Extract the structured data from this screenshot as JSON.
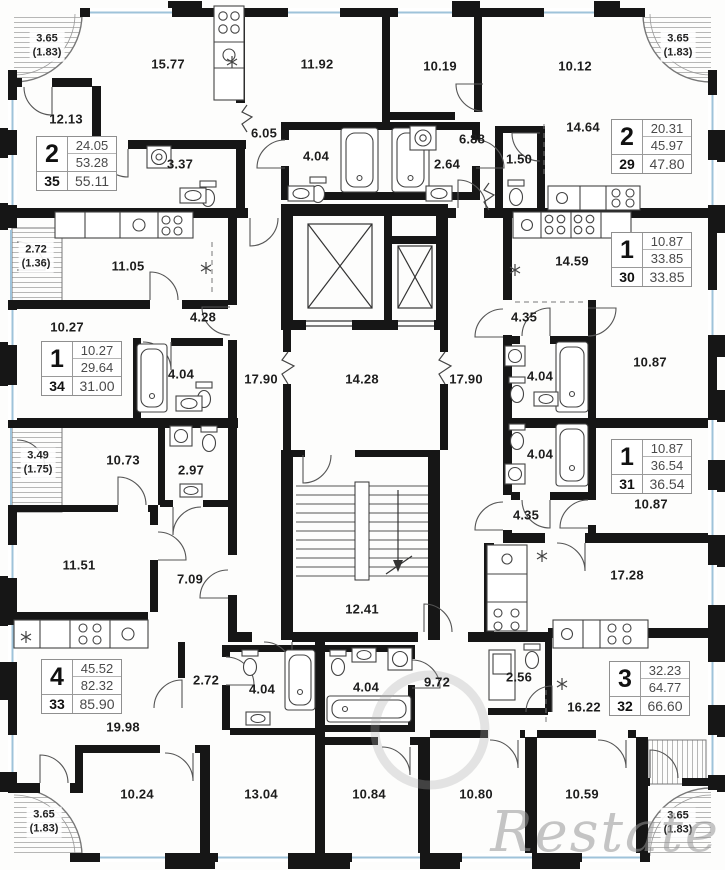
{
  "watermark": "Restate",
  "apartments": [
    {
      "rooms": "2",
      "living": "24.05",
      "area": "53.28",
      "number": "35",
      "total": "55.11"
    },
    {
      "rooms": "2",
      "living": "20.31",
      "area": "45.97",
      "number": "29",
      "total": "47.80"
    },
    {
      "rooms": "1",
      "living": "10.27",
      "area": "29.64",
      "number": "34",
      "total": "31.00"
    },
    {
      "rooms": "1",
      "living": "10.87",
      "area": "33.85",
      "number": "30",
      "total": "33.85"
    },
    {
      "rooms": "1",
      "living": "10.87",
      "area": "36.54",
      "number": "31",
      "total": "36.54"
    },
    {
      "rooms": "4",
      "living": "45.52",
      "area": "82.32",
      "number": "33",
      "total": "85.90"
    },
    {
      "rooms": "3",
      "living": "32.23",
      "area": "64.77",
      "number": "32",
      "total": "66.60"
    }
  ],
  "room_labels": [
    {
      "v": "15.77"
    },
    {
      "v": "12.13"
    },
    {
      "v": "3.37"
    },
    {
      "v": "6.05"
    },
    {
      "v": "11.92"
    },
    {
      "v": "4.04"
    },
    {
      "v": "2.64"
    },
    {
      "v": "10.19"
    },
    {
      "v": "6.88"
    },
    {
      "v": "1.50"
    },
    {
      "v": "14.64"
    },
    {
      "v": "10.12"
    },
    {
      "v": "11.05"
    },
    {
      "v": "4.28"
    },
    {
      "v": "10.27"
    },
    {
      "v": "4.04"
    },
    {
      "v": "17.90"
    },
    {
      "v": "14.28"
    },
    {
      "v": "17.90"
    },
    {
      "v": "14.59"
    },
    {
      "v": "4.35"
    },
    {
      "v": "4.04"
    },
    {
      "v": "10.87"
    },
    {
      "v": "10.73"
    },
    {
      "v": "2.97"
    },
    {
      "v": "11.51"
    },
    {
      "v": "7.09"
    },
    {
      "v": "12.41"
    },
    {
      "v": "4.04"
    },
    {
      "v": "10.87"
    },
    {
      "v": "4.35"
    },
    {
      "v": "17.28"
    },
    {
      "v": "19.98"
    },
    {
      "v": "2.72"
    },
    {
      "v": "10.24"
    },
    {
      "v": "4.04"
    },
    {
      "v": "4.04"
    },
    {
      "v": "9.72"
    },
    {
      "v": "13.04"
    },
    {
      "v": "10.84"
    },
    {
      "v": "10.80"
    },
    {
      "v": "10.59"
    },
    {
      "v": "2.56"
    },
    {
      "v": "16.22"
    }
  ],
  "balcony_labels": [
    {
      "a": "3.65",
      "b": "(1.83)"
    },
    {
      "a": "3.65",
      "b": "(1.83)"
    },
    {
      "a": "2.72",
      "b": "(1.36)"
    },
    {
      "a": "3.49",
      "b": "(1.75)"
    },
    {
      "a": "3.65",
      "b": "(1.83)"
    },
    {
      "a": "3.65",
      "b": "(1.83)"
    }
  ]
}
